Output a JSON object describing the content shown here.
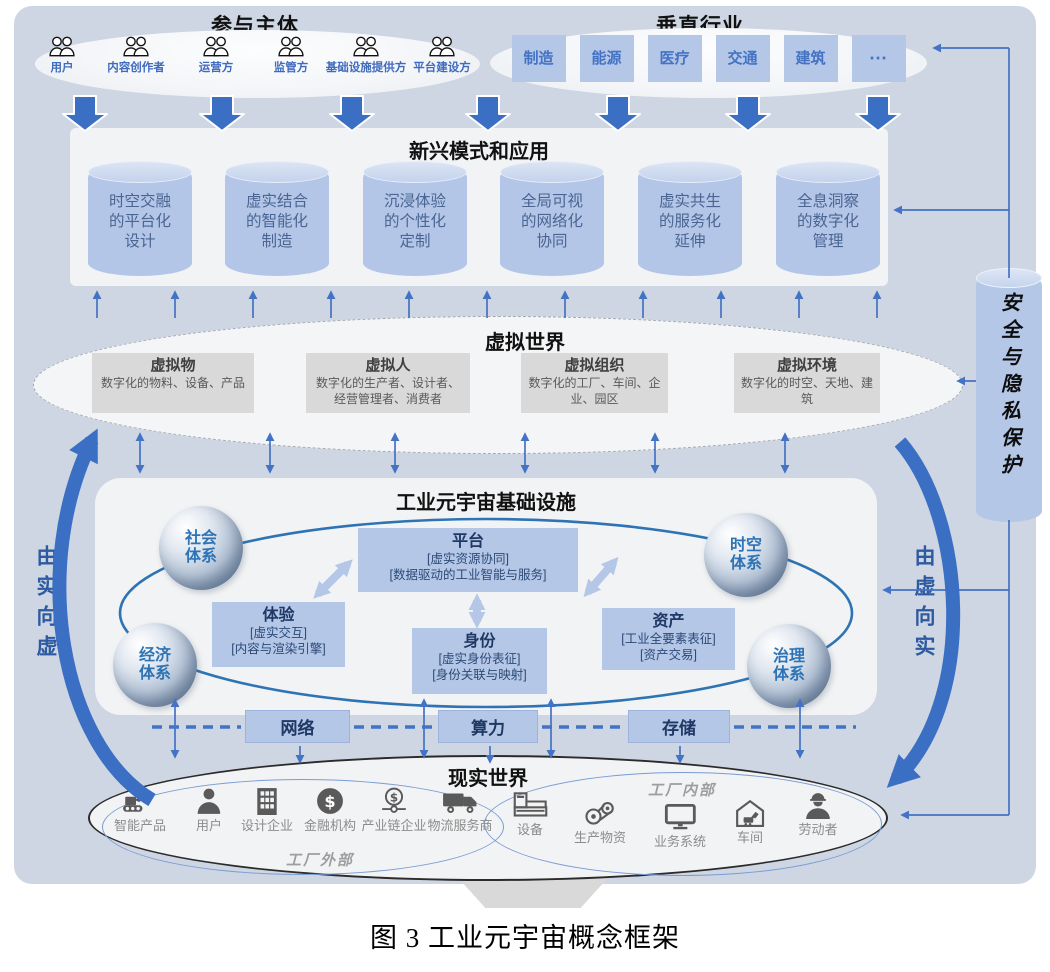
{
  "caption": "图 3 工业元宇宙概念框架",
  "participants": {
    "title": "参与主体",
    "items": [
      "用户",
      "内容创作者",
      "运营方",
      "监管方",
      "基础设施提供方",
      "平台建设方"
    ]
  },
  "industries": {
    "title": "垂直行业",
    "items": [
      "制造",
      "能源",
      "医疗",
      "交通",
      "建筑",
      "⋯"
    ]
  },
  "applications": {
    "title": "新兴模式和应用",
    "cylinders": [
      "时空交融的平台化设计",
      "虚实结合的智能化制造",
      "沉浸体验的个性化定制",
      "全局可视的网络化协同",
      "虚实共生的服务化延伸",
      "全息洞察的数字化管理"
    ]
  },
  "virtual_world": {
    "title": "虚拟世界",
    "boxes": [
      {
        "title": "虚拟物",
        "desc": "数字化的物料、设备、产品"
      },
      {
        "title": "虚拟人",
        "desc": "数字化的生产者、设计者、经营管理者、消费者"
      },
      {
        "title": "虚拟组织",
        "desc": "数字化的工厂、车间、企业、园区"
      },
      {
        "title": "虚拟环境",
        "desc": "数字化的时空、天地、建筑"
      }
    ]
  },
  "infrastructure": {
    "title": "工业元宇宙基础设施",
    "spheres": [
      "社会体系",
      "经济体系",
      "时空体系",
      "治理体系"
    ],
    "platform": {
      "title": "平台",
      "lines": [
        "[虚实资源协同]",
        "[数据驱动的工业智能与服务]"
      ]
    },
    "experience": {
      "title": "体验",
      "lines": [
        "[虚实交互]",
        "[内容与渲染引擎]"
      ]
    },
    "identity": {
      "title": "身份",
      "lines": [
        "[虚实身份表征]",
        "[身份关联与映射]"
      ]
    },
    "asset": {
      "title": "资产",
      "lines": [
        "[工业全要素表征]",
        "[资产交易]"
      ]
    },
    "resources": [
      "网络",
      "算力",
      "存储"
    ]
  },
  "real_world": {
    "title": "现实世界",
    "outside": {
      "label": "工厂外部",
      "items": [
        "智能产品",
        "用户",
        "设计企业",
        "金融机构",
        "产业链企业",
        "物流服务商"
      ]
    },
    "inside": {
      "label": "工厂内部",
      "items": [
        "设备",
        "生产物资",
        "业务系统",
        "车间",
        "劳动者"
      ]
    }
  },
  "flows": {
    "left": "由实向虚",
    "right": "由虚向实",
    "security": "安全与隐私保护"
  },
  "colors": {
    "accent_blue": "#4472c4",
    "light_blue": "#b4c7e7",
    "ring_blue": "#2e74b5",
    "background_blue": "#cdd6e2"
  }
}
